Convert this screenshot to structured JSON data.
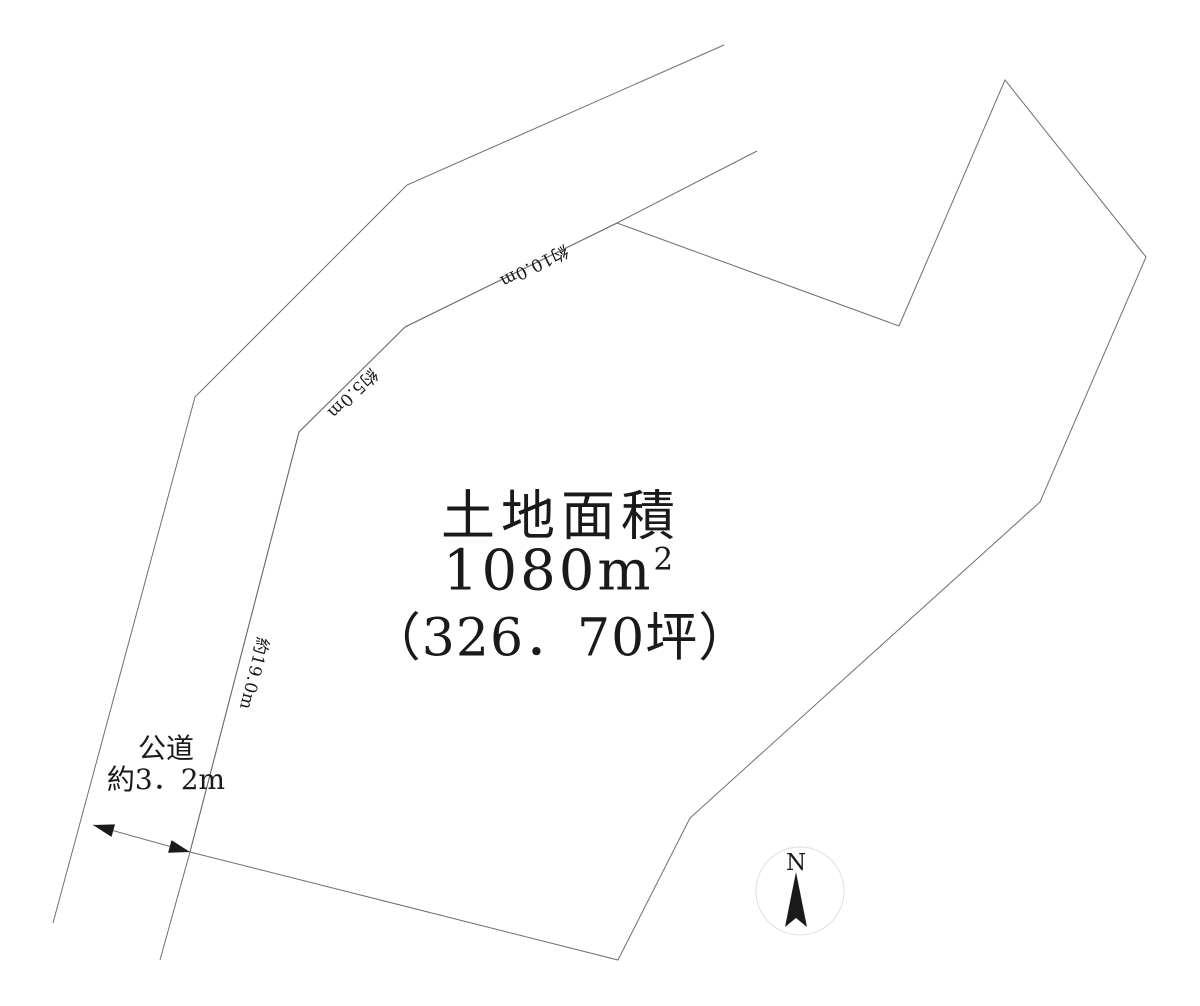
{
  "diagram": {
    "area": {
      "title": "土地面積",
      "value": "1080",
      "unit_base": "m",
      "unit_exponent": "2",
      "tsubo": "（326．70坪）"
    },
    "edge_labels": {
      "top": "約10.0m",
      "upper_left": "約5.0m",
      "left": "約19.0m"
    },
    "road": {
      "name": "公道",
      "width": "約3．2m"
    },
    "compass": {
      "north_label": "N"
    },
    "colors": {
      "line": "#6e6e6e",
      "ink": "#1a1a1a",
      "compass_circle": "#e0e0e0",
      "background": "#ffffff"
    }
  }
}
